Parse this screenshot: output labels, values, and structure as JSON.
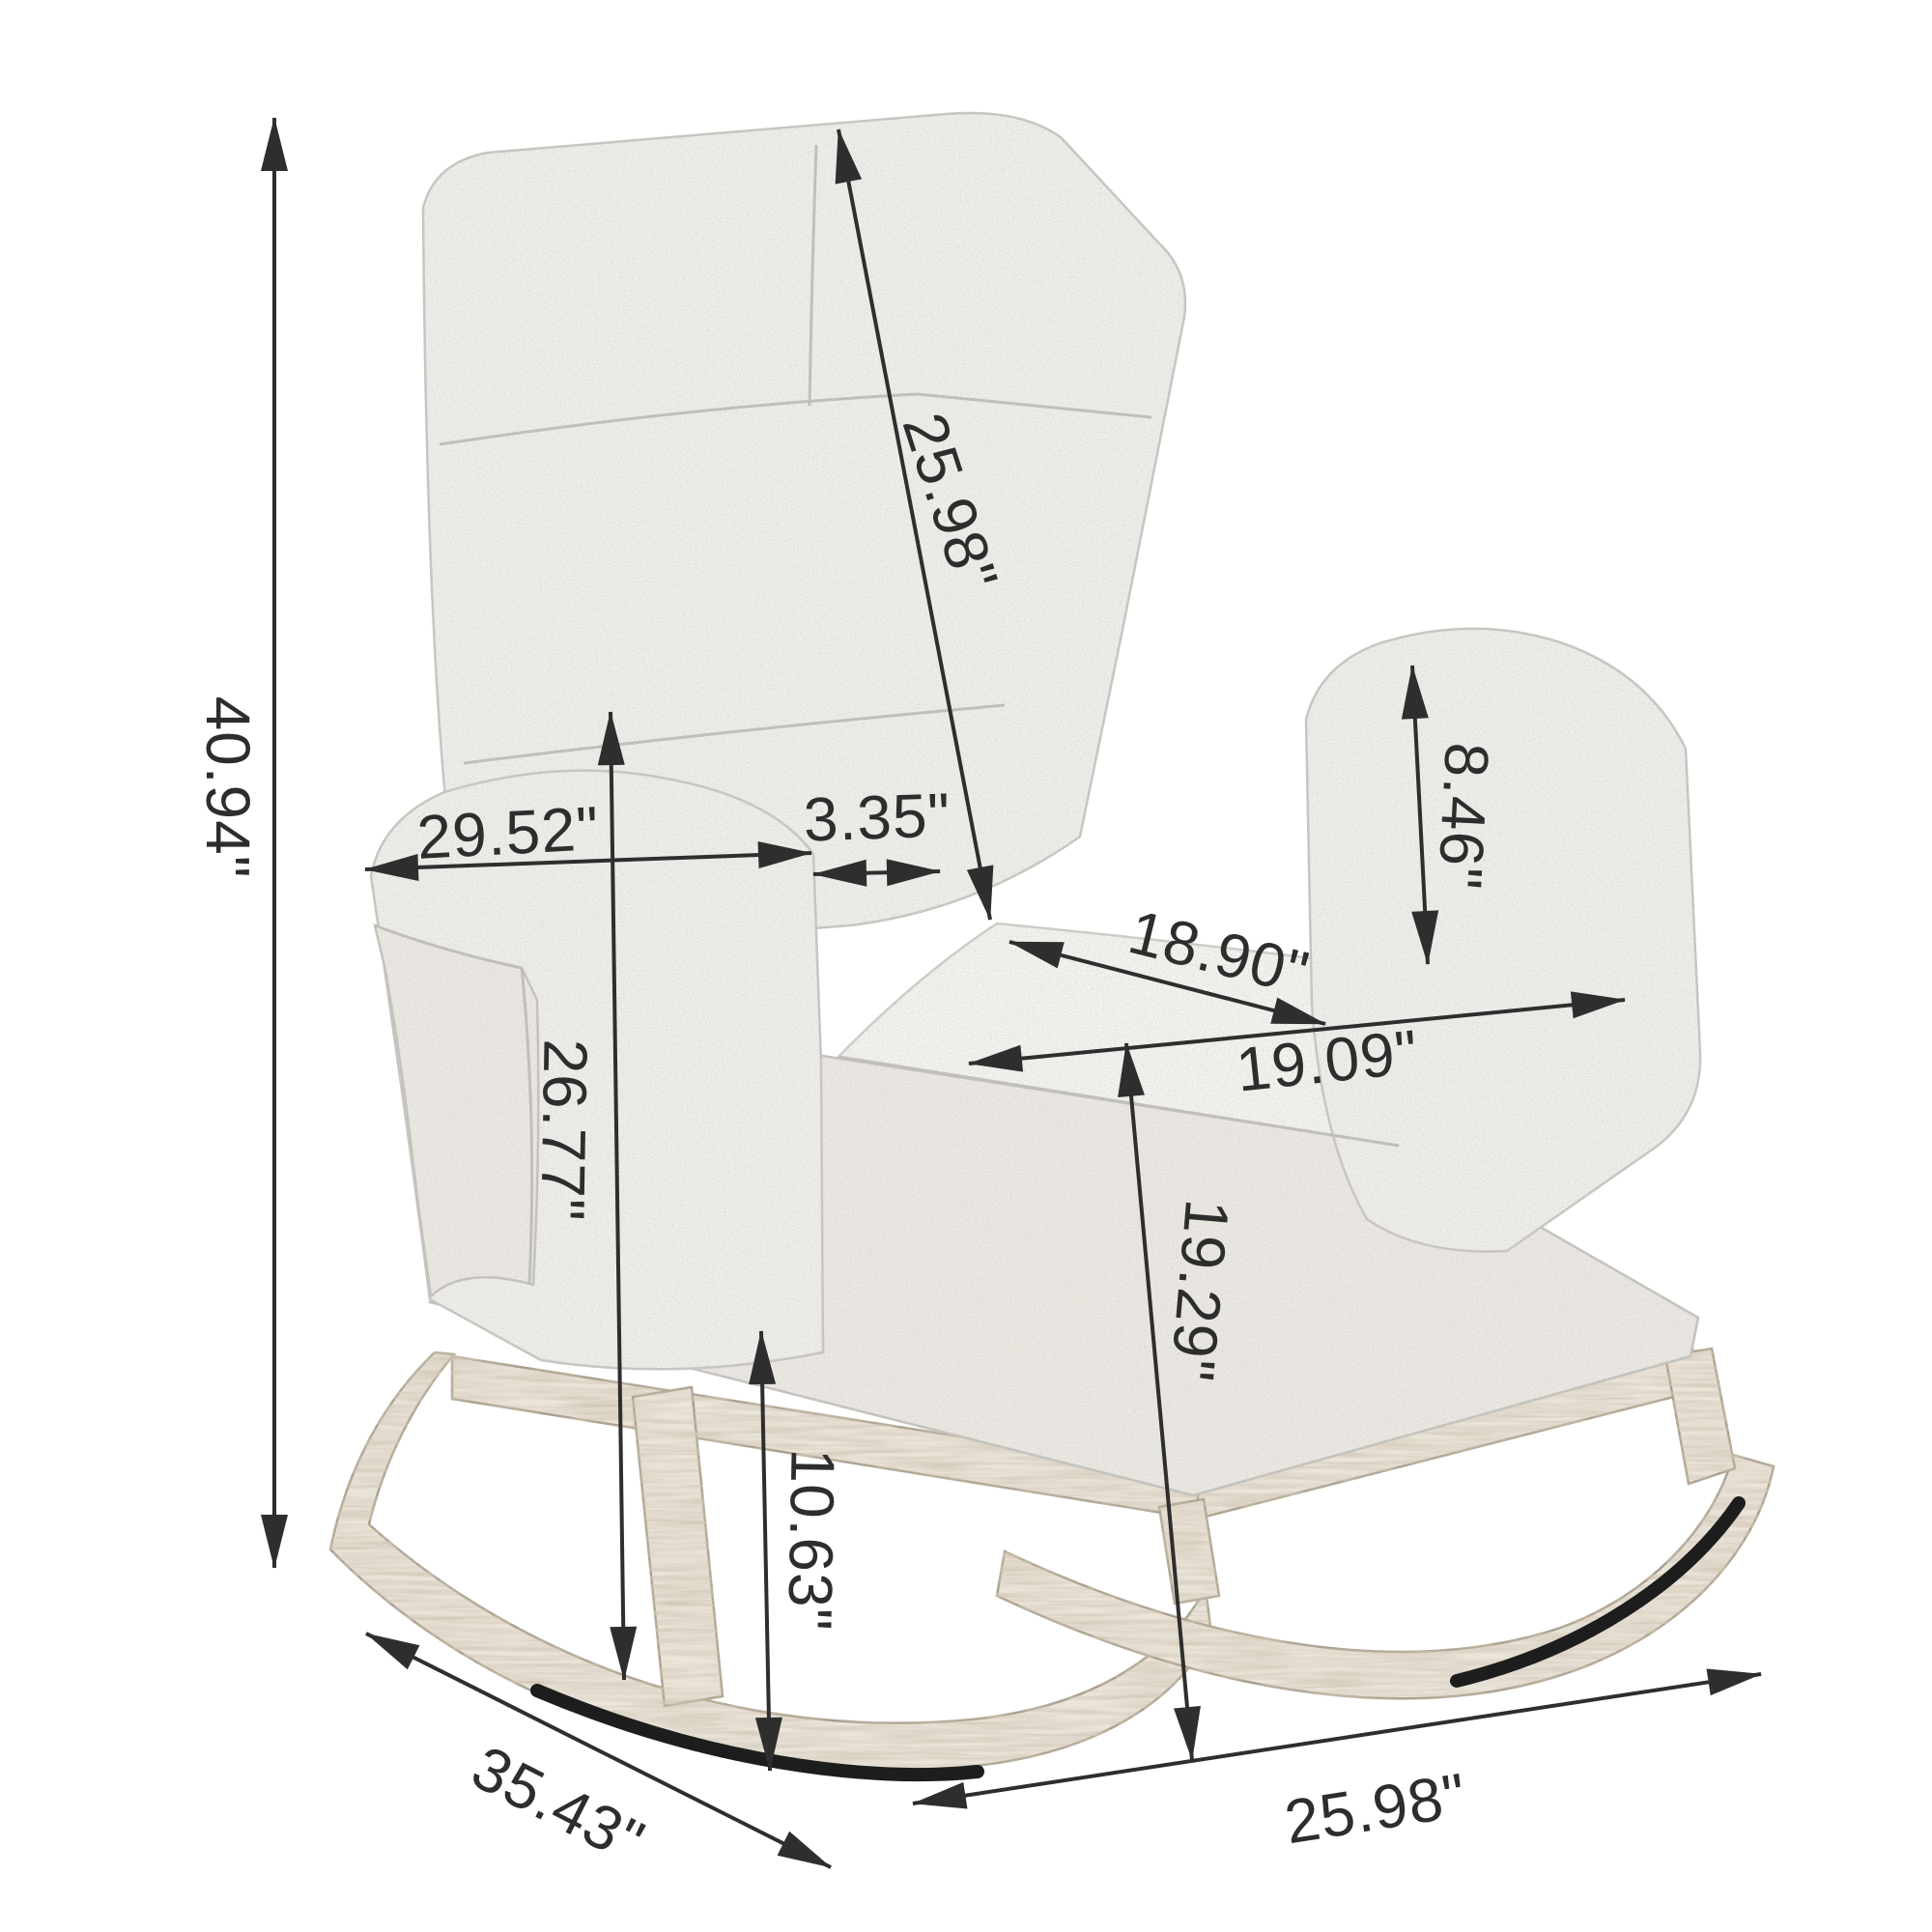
{
  "diagram": {
    "type": "product-dimension-diagram",
    "product": "upholstered rocking chair with wooden rocker base and side pocket",
    "background": "#ffffff",
    "unit_symbol": "\"",
    "dimensions": {
      "overall_height": {
        "label": "40.94\"",
        "value": 40.94
      },
      "backrest_length": {
        "label": "25.98\"",
        "value": 25.98
      },
      "overall_width": {
        "label": "29.52\"",
        "value": 29.52
      },
      "backrest_thickness": {
        "label": "3.35\"",
        "value": 3.35
      },
      "armrest_above_seat": {
        "label": "8.46\"",
        "value": 8.46
      },
      "seat_depth": {
        "label": "18.90\"",
        "value": 18.9
      },
      "seat_width": {
        "label": "19.09\"",
        "value": 19.09
      },
      "armrest_height": {
        "label": "26.77\"",
        "value": 26.77
      },
      "seat_height": {
        "label": "19.29\"",
        "value": 19.29
      },
      "base_height": {
        "label": "10.63\"",
        "value": 10.63
      },
      "overall_depth": {
        "label": "35.43\"",
        "value": 35.43
      },
      "base_length": {
        "label": "25.98\"",
        "value": 25.98
      }
    },
    "colors": {
      "fabric": "#f2f0ec",
      "fabric_highlight": "#f7f5f1",
      "fabric_shadow": "#edeae4",
      "fabric_outline": "#c6c4be",
      "wood": "#ebe5da",
      "wood_outline": "#a89e8c",
      "glide_strip": "#1d1d1d",
      "dimension_ink": "#2d2d2d",
      "background": "#ffffff"
    }
  }
}
